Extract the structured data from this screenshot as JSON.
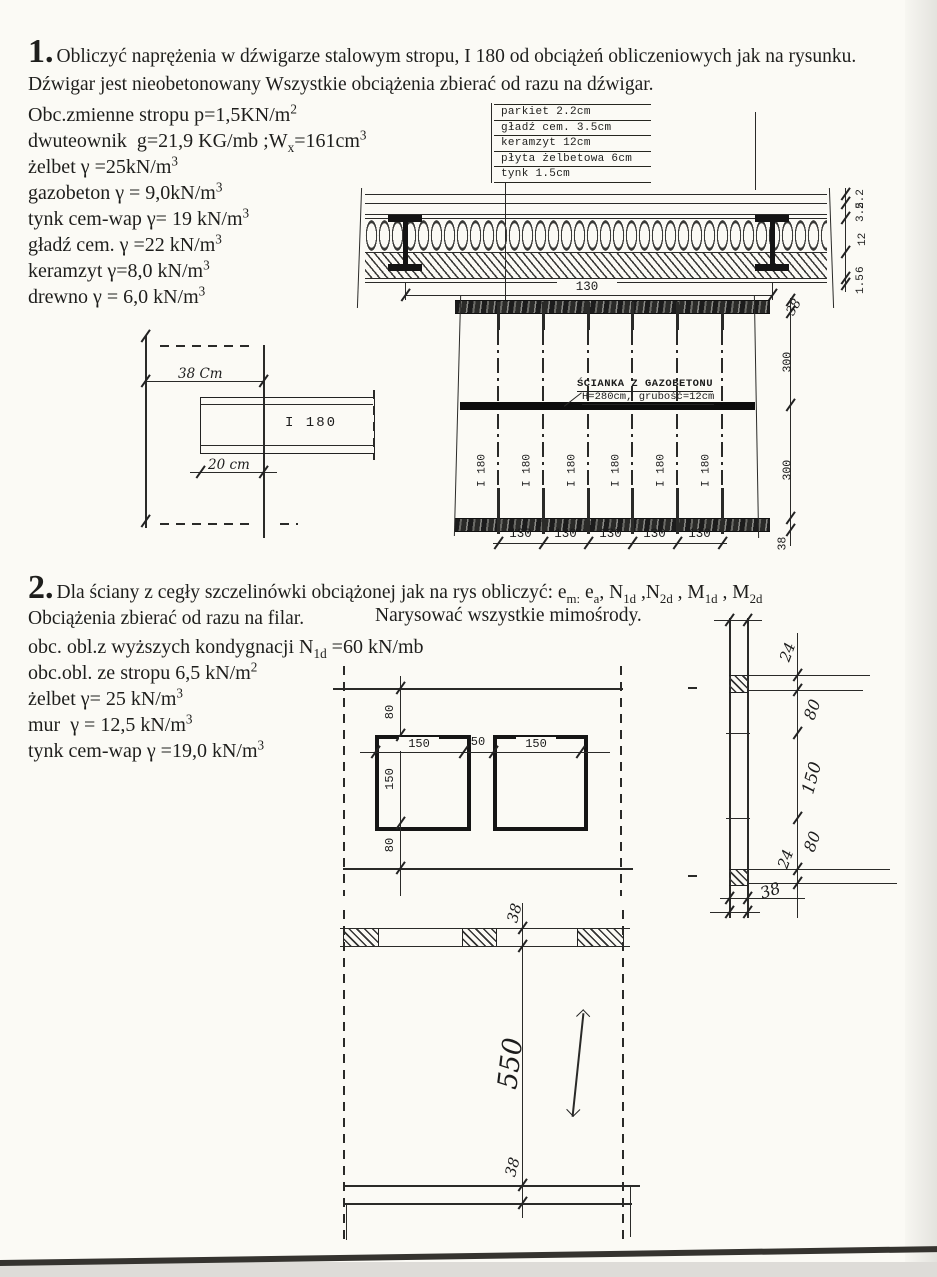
{
  "problem1": {
    "number": "1.",
    "statement": "Obliczyć naprężenia w dźwigarze stalowym stropu, I 180 od obciążeń obliczeniowych jak na rysunku. Dźwigar jest nieobetonowany Wszystkie obciążenia zbierać od razu na dźwigar.",
    "properties": [
      {
        "segs": [
          {
            "t": "Obc.zmienne stropu p=1,5KN/m"
          },
          {
            "t": "2",
            "s": "sup"
          }
        ]
      },
      {
        "segs": [
          {
            "t": "dwuteownik  g=21,9 KG/mb ;W"
          },
          {
            "t": "x",
            "s": "sub"
          },
          {
            "t": "=161cm"
          },
          {
            "t": "3",
            "s": "sup"
          }
        ]
      },
      {
        "segs": [
          {
            "t": "żelbet γ =25kN/m"
          },
          {
            "t": "3",
            "s": "sup"
          }
        ]
      },
      {
        "segs": [
          {
            "t": "gazobeton γ = 9,0kN/m"
          },
          {
            "t": "3",
            "s": "sup"
          }
        ]
      },
      {
        "segs": [
          {
            "t": "tynk cem-wap γ= 19 kN/m"
          },
          {
            "t": "3",
            "s": "sup"
          }
        ]
      },
      {
        "segs": [
          {
            "t": "gładź cem. γ =22 kN/m"
          },
          {
            "t": "3",
            "s": "sup"
          }
        ]
      },
      {
        "segs": [
          {
            "t": "keramzyt γ=8,0 kN/m"
          },
          {
            "t": "3",
            "s": "sup"
          }
        ]
      },
      {
        "segs": [
          {
            "t": "drewno γ = 6,0 kN/m"
          },
          {
            "t": "3",
            "s": "sup"
          }
        ]
      }
    ],
    "layers_legend": [
      "parkiet 2.2cm",
      "gładź cem. 3.5cm",
      "keramzyt 12cm",
      "płyta żelbetowa 6cm",
      "tynk 1.5cm"
    ],
    "section": {
      "span_dim": "130",
      "layer_dims": [
        "2.2",
        "3.5",
        "12",
        "6",
        "1.5"
      ]
    },
    "plan": {
      "wall_label_line1": "ŚCIANKA Z GAZOBETONU",
      "wall_label_line2": "H=280cm, grubość=12cm",
      "beam_label": "I 180",
      "spacing_dims": [
        "130",
        "130",
        "130",
        "130",
        "130"
      ],
      "right_dims": [
        "38",
        "300",
        "300",
        "38"
      ]
    },
    "detail": {
      "beam_label": "I 180",
      "top_dim": "38 Cm",
      "bottom_dim": "20 cm"
    }
  },
  "problem2": {
    "number": "2.",
    "statement_segs": [
      {
        "t": "Dla ściany z cegły szczelinówki obciążonej jak na rys obliczyć: e"
      },
      {
        "t": "m:",
        "s": "sub"
      },
      {
        "t": " e"
      },
      {
        "t": "a",
        "s": "sub"
      },
      {
        "t": ", N"
      },
      {
        "t": "1d",
        "s": "sub"
      },
      {
        "t": " ,N"
      },
      {
        "t": "2d",
        "s": "sub"
      },
      {
        "t": " , M"
      },
      {
        "t": "1d",
        "s": "sub"
      },
      {
        "t": " , M"
      },
      {
        "t": "2d",
        "s": "sub"
      }
    ],
    "line2_left": "Obciążenia zbierać od razu na filar.",
    "line2_right": "Narysować wszystkie mimośrody.",
    "loads": [
      {
        "segs": [
          {
            "t": "obc. obl.z wyższych kondygnacji N"
          },
          {
            "t": "1d",
            "s": "sub"
          },
          {
            "t": " =60 kN/mb"
          }
        ]
      },
      {
        "segs": [
          {
            "t": "obc.obl. ze stropu 6,5 kN/m"
          },
          {
            "t": "2",
            "s": "sup"
          }
        ]
      },
      {
        "segs": [
          {
            "t": "żelbet γ= 25 kN/m"
          },
          {
            "t": "3",
            "s": "sup"
          }
        ]
      },
      {
        "segs": [
          {
            "t": "mur  γ = 12,5 kN/m"
          },
          {
            "t": "3",
            "s": "sup"
          }
        ]
      },
      {
        "segs": [
          {
            "t": "tynk cem-wap γ =19,0 kN/m"
          },
          {
            "t": "3",
            "s": "sup"
          }
        ]
      }
    ],
    "elevation": {
      "top_dim": "80",
      "win1_w": "150",
      "pier_dim": "50",
      "win2_w": "150",
      "win_h": "150",
      "bottom_dim": "80"
    },
    "wall_section": {
      "dims": [
        "24",
        "80",
        "150",
        "80",
        "24"
      ],
      "thickness": "38"
    },
    "plan": {
      "top_dim": "38",
      "span_dim": "550",
      "bottom_dim": "38"
    }
  }
}
